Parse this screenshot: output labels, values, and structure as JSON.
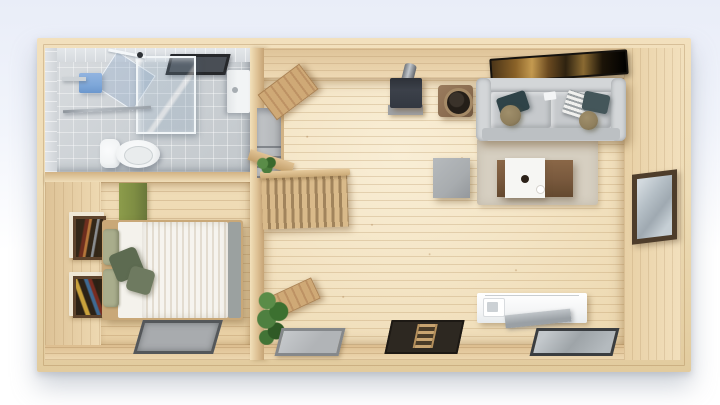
{
  "meta": {
    "description": "Top-down 3D architectural render of a small one-room wooden cabin floor plan with pine plank flooring on a pale blue-to-white studio background"
  },
  "palette": {
    "bg_top": "#e9edf8",
    "bg_bottom": "#ffffff",
    "wood_edge": "#eedcb6",
    "central_wall": "#ddc093",
    "wall_face_light": "#f0ddb8",
    "floor": "#f4e5c6",
    "tile_floor": "#cbd0d4",
    "tile_wall": "#d6dade",
    "vent_dark": "#26282b",
    "vent_inner": "#494e55",
    "glass_frame": "#f2f6f8",
    "porcelain": "#f2f4f5",
    "towel_blue": "#7ea7d9",
    "chrome": "#b7bdc3",
    "frame_cream": "#efe7d5",
    "frame_brown": "#5d432c",
    "headboard_green": "#7e8d43",
    "pillow_sage": "#a9ad8c",
    "pillow_olive": "#5d6b51",
    "duvet": "#f6f4ef",
    "duvet_rib": "#e3dcd0",
    "blanket_gray": "#9ba1a0",
    "bed_frame": "#c9a878",
    "mat_frame": "#54575a",
    "mat_inner": "#a8abae",
    "stairwell": "#b6b9bc",
    "stair_wood": "#d9ba8a",
    "stair_gap": "#a1845c",
    "door_wood": "#cfa976",
    "door_edge": "#ab8253",
    "stove_body": "#3c414a",
    "stove_base": "#9fa2a6",
    "side_table": "#8a6c50",
    "side_table_rim": "#a58a67",
    "side_table_hole": "#241e18",
    "tv_frame": "#15120e",
    "sofa": "#c6c9cc",
    "sofa_light": "#d3d6d8",
    "pillow_teal": "#2f4348",
    "cushion_olive": "#8f7f5d",
    "rug": "#d6cfc1",
    "table_brown": "#7a5a3e",
    "tray_white": "#f6f6f3",
    "ottoman": "#a8acaf",
    "window_frame": "#4e3d2b",
    "window_glass": "#b5bfc6",
    "counter_white": "#f4f5f6",
    "counter_top": "#9aa0a5",
    "hatch_brown": "#2d2821",
    "ladder": "#c8a470"
  },
  "scene": {
    "rooms": [
      {
        "id": "bathroom",
        "label": "Bathroom",
        "items": [
          "gray tiled floor",
          "dark ceiling vent",
          "glass shower enclosure",
          "open glass shower door",
          "wall shelf",
          "blue towel",
          "chrome towel bar",
          "toilet",
          "wall-hung sink cabinet"
        ]
      },
      {
        "id": "bedroom",
        "label": "Bedroom",
        "items": [
          "green headboard panel",
          "double bed with ribbed white duvet",
          "sage green pillows",
          "two olive throw pillows",
          "gray bed runner",
          "framed artwork x2",
          "recessed gray floor mat"
        ]
      },
      {
        "id": "stair-hall",
        "label": "Stair hall",
        "items": [
          "gray stairwell with steps",
          "wood balustrade with slats",
          "newel plant",
          "open wood door north",
          "open wood door south",
          "potted plant",
          "gray floor hatch",
          "dark floor hatch with ladder"
        ]
      },
      {
        "id": "living-room",
        "label": "Living room",
        "items": [
          "wall-mounted flat TV",
          "gray three-seat sofa",
          "teal accent pillows",
          "round olive cushions",
          "white remote",
          "gray knit throw",
          "wood stove with flue pipe",
          "round-top brown side table",
          "beige area rug",
          "brown coffee table with white tray",
          "gray ottoman cube",
          "picture window"
        ]
      },
      {
        "id": "kitchenette",
        "label": "Kitchenette",
        "items": [
          "white counter",
          "gray countertop slab",
          "small wall appliance",
          "glass floor hatch"
        ]
      }
    ]
  }
}
